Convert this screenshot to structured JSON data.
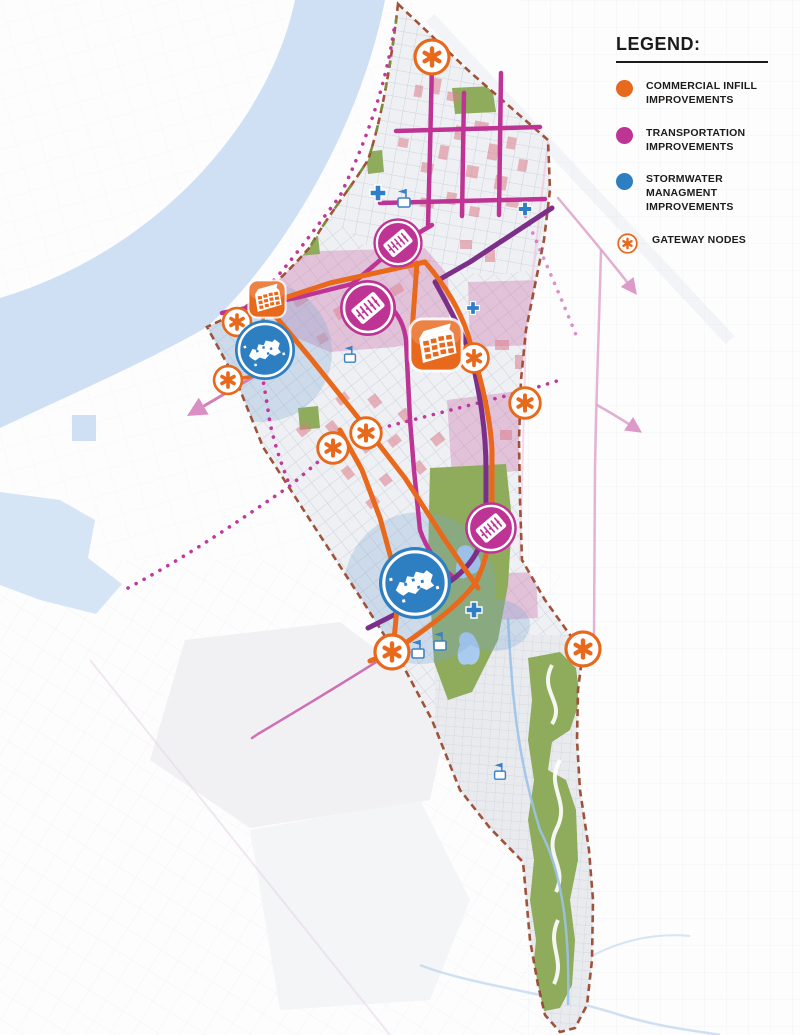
{
  "legend": {
    "title": "LEGEND:",
    "items": [
      {
        "id": "commercial",
        "label": "COMMERCIAL INFILL\nIMPROVEMENTS"
      },
      {
        "id": "transportation",
        "label": "TRANSPORTATION\nIMPROVEMENTS"
      },
      {
        "id": "stormwater",
        "label": "STORMWATER MANAGMENT\nIMPROVEMENTS"
      },
      {
        "id": "gateway",
        "label": "GATEWAY NODES"
      }
    ]
  },
  "map": {
    "marker_counts": {
      "gateway_nodes": 9,
      "commercial_infill_icons": 2,
      "transportation_icons": 3,
      "stormwater_icons": 2
    }
  },
  "colors": {
    "commercial": "#E8681C",
    "transportation": "#BE3495",
    "stormwater": "#2E7EC2",
    "gateway": "#E8681C",
    "purple-route": "#7C2F88",
    "river": "#CFE0F4",
    "park": "#8FAB5C",
    "pink-zone": "#C85AA0",
    "parcel": "#DC7E8C",
    "boundary": "#9A4A2F",
    "rail": "#C2379E",
    "faint-pink": "#DFA6CC",
    "halo": "#7FA8D4"
  }
}
